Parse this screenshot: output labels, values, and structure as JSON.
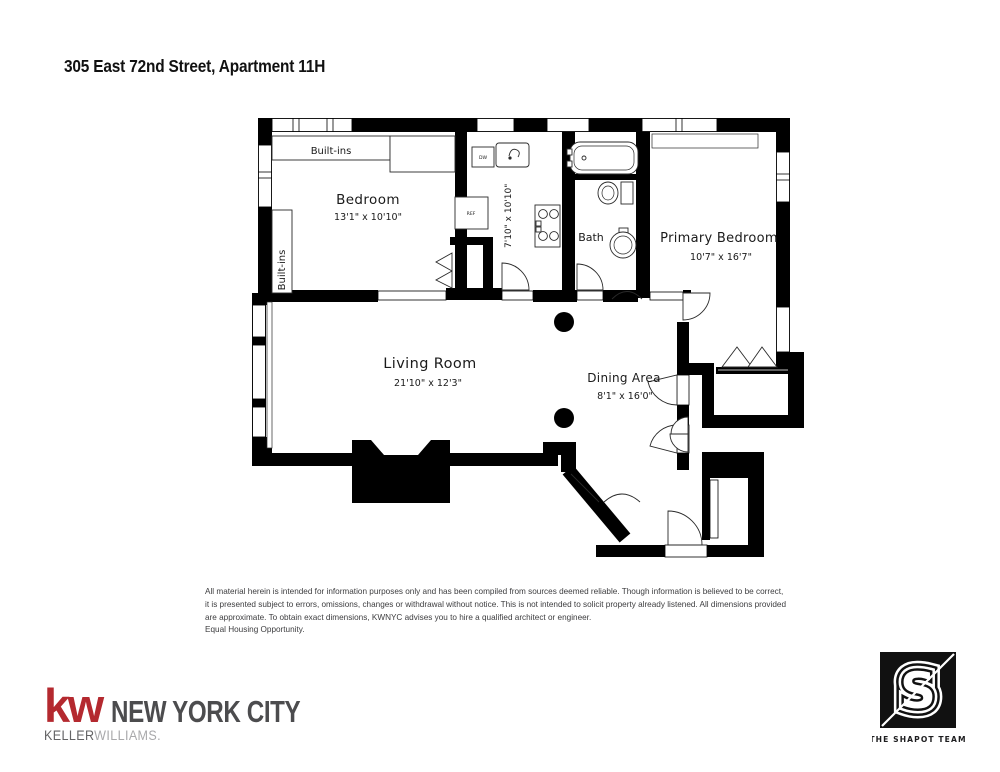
{
  "page": {
    "title": "305 East 72nd Street, Apartment 11H"
  },
  "floorplan": {
    "rooms": {
      "bedroom": {
        "name": "Bedroom",
        "dims": "13'1\" x 10'10\""
      },
      "kitchen": {
        "dims": "7'10\" x 10'10\""
      },
      "bath": {
        "name": "Bath"
      },
      "primary_bedroom": {
        "name": "Primary Bedroom",
        "dims": "10'7\" x 16'7\""
      },
      "living_room": {
        "name": "Living Room",
        "dims": "21'10\" x 12'3\""
      },
      "dining_area": {
        "name": "Dining Area",
        "dims": "8'1\" x 16'0\""
      }
    },
    "labels": {
      "built_ins_top": "Built-ins",
      "built_ins_side": "Built-ins",
      "dishwasher": "DW",
      "refrigerator": "REF"
    }
  },
  "disclaimer": {
    "line1": "All material herein is intended for information purposes only and has been compiled from sources deemed reliable. Though information is believed to be correct,",
    "line2": "it is presented subject to errors, omissions, changes or withdrawal without notice. This is not intended to solicit property already listened. All dimensions provided",
    "line3": "are approximate. To obtain exact dimensions, KWNYC advises you to hire a qualified architect or engineer.",
    "line4": "Equal Housing Opportunity."
  },
  "footer": {
    "kw": {
      "mark": "kw",
      "city": "NEW YORK CITY",
      "keller": "KELLER",
      "williams": "WILLIAMS."
    },
    "team": {
      "initial": "S",
      "name": "THE SHAPOT TEAM"
    }
  },
  "colors": {
    "kw_red": "#b4292f",
    "kw_dark_gray": "#4c4c4e",
    "kw_light_gray": "#a9a9ab",
    "wall": "#000000"
  }
}
